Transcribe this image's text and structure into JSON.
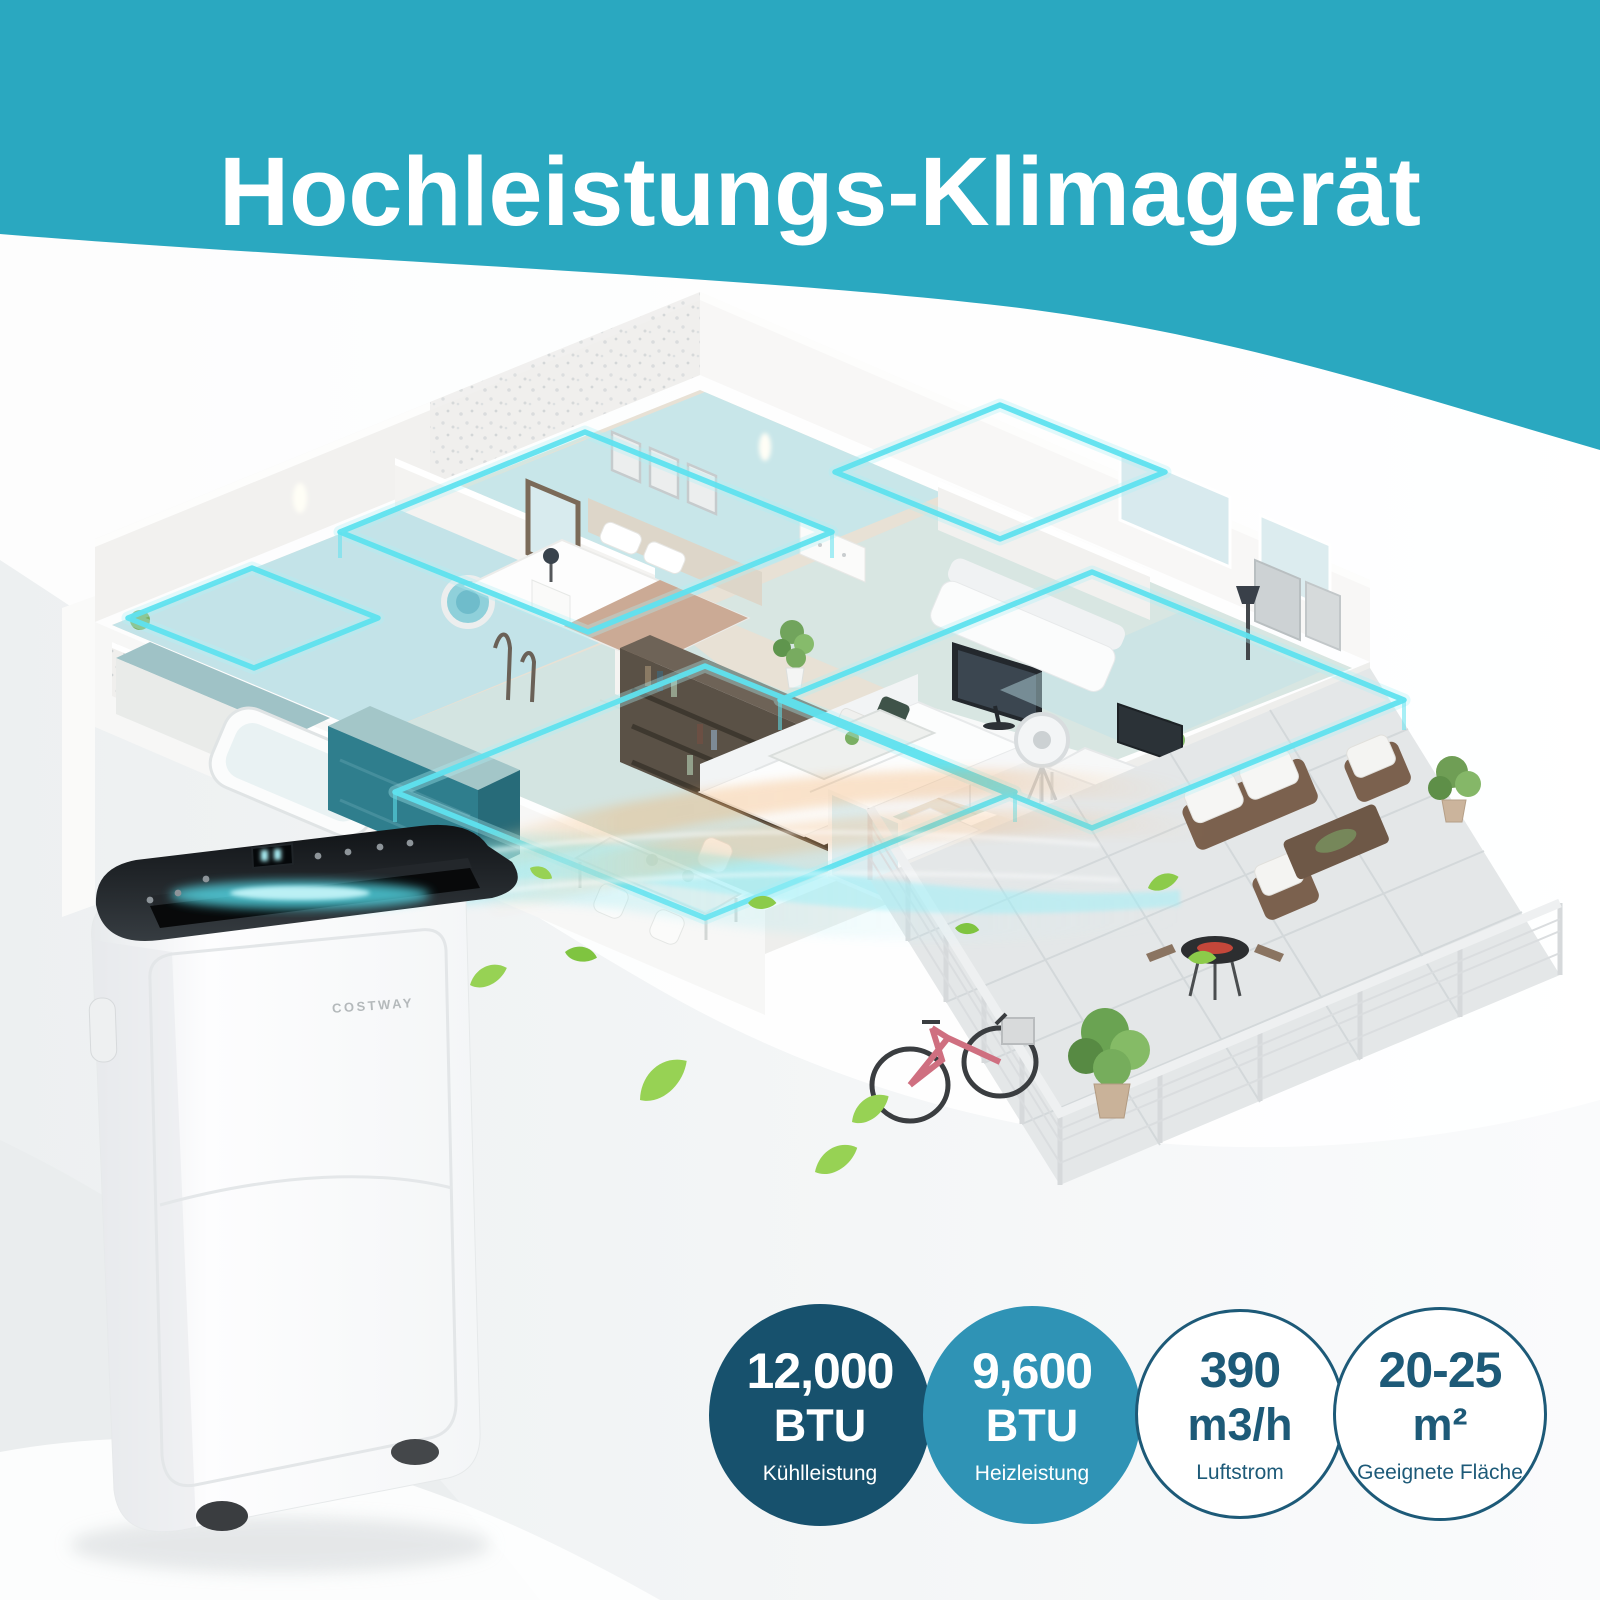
{
  "header": {
    "title": "Hochleistungs-Klimagerät"
  },
  "brand": {
    "name": "COSTWAY"
  },
  "badges": [
    {
      "value": "12,000",
      "unit": "BTU",
      "label": "Kühlleistung"
    },
    {
      "value": "9,600",
      "unit": "BTU",
      "label": "Heizleistung"
    },
    {
      "value": "390",
      "unit": "m3/h",
      "label": "Luftstrom"
    },
    {
      "value": "20-25",
      "unit": "m²",
      "label": "Geeignete Fläche"
    }
  ],
  "colors": {
    "header_teal": "#2aa8c0",
    "badge_dark_navy": "#17516d",
    "badge_blue": "#2f93b5",
    "badge_outline_blue": "#1d5a78",
    "airflow_cyan": "#5fe2ef",
    "warm_air_orange": "#f3a65c",
    "leaf_green": "#97d254",
    "kitchen_teal": "#2f7e8d",
    "bicycle_pink": "#cf6f80"
  }
}
